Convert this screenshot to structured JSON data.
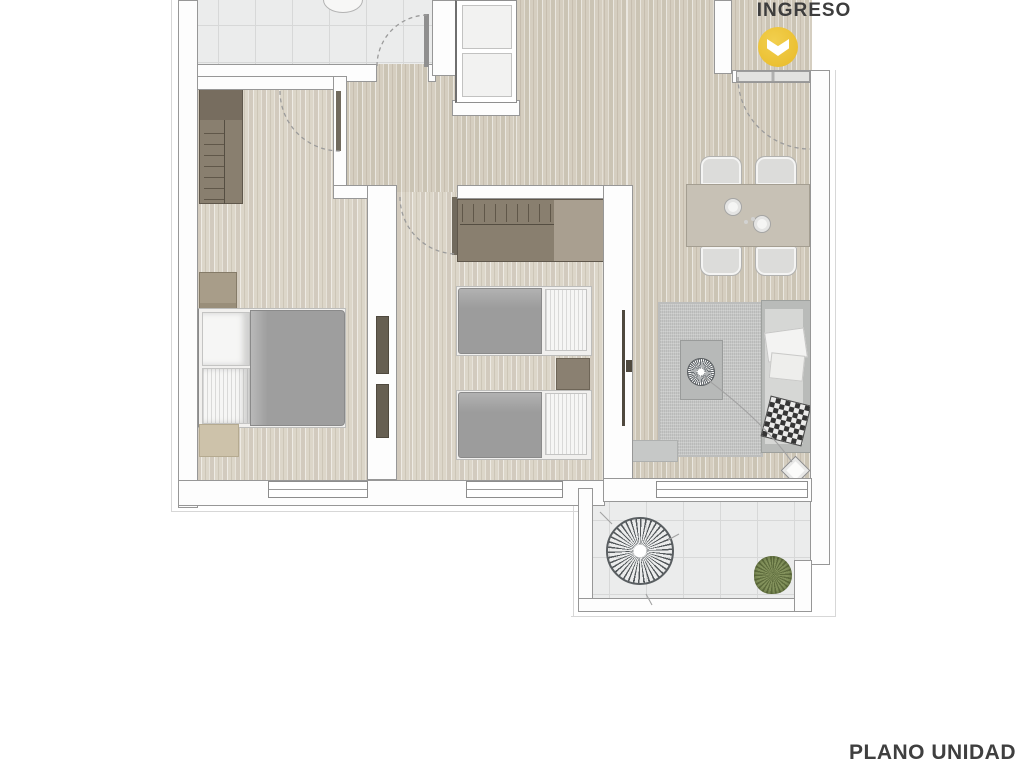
{
  "entrance": {
    "label": "INGRESO",
    "marker_icon": "chevron-down",
    "marker_color": "#ecc238"
  },
  "footer": {
    "label": "PLANO UNIDAD"
  },
  "palette": {
    "background": "#ffffff",
    "wood_floor": "#d5cec0",
    "tile_floor": "#ebecec",
    "wall_outline": "#979797",
    "wardrobe_brown": "#897f6f",
    "fabric_gray": "#9e9e9e",
    "rug_gray": "#c6c7c6",
    "plant_green": "#76854f",
    "accent_yellow": "#ecc238",
    "text_dark": "#3d3d3d"
  }
}
